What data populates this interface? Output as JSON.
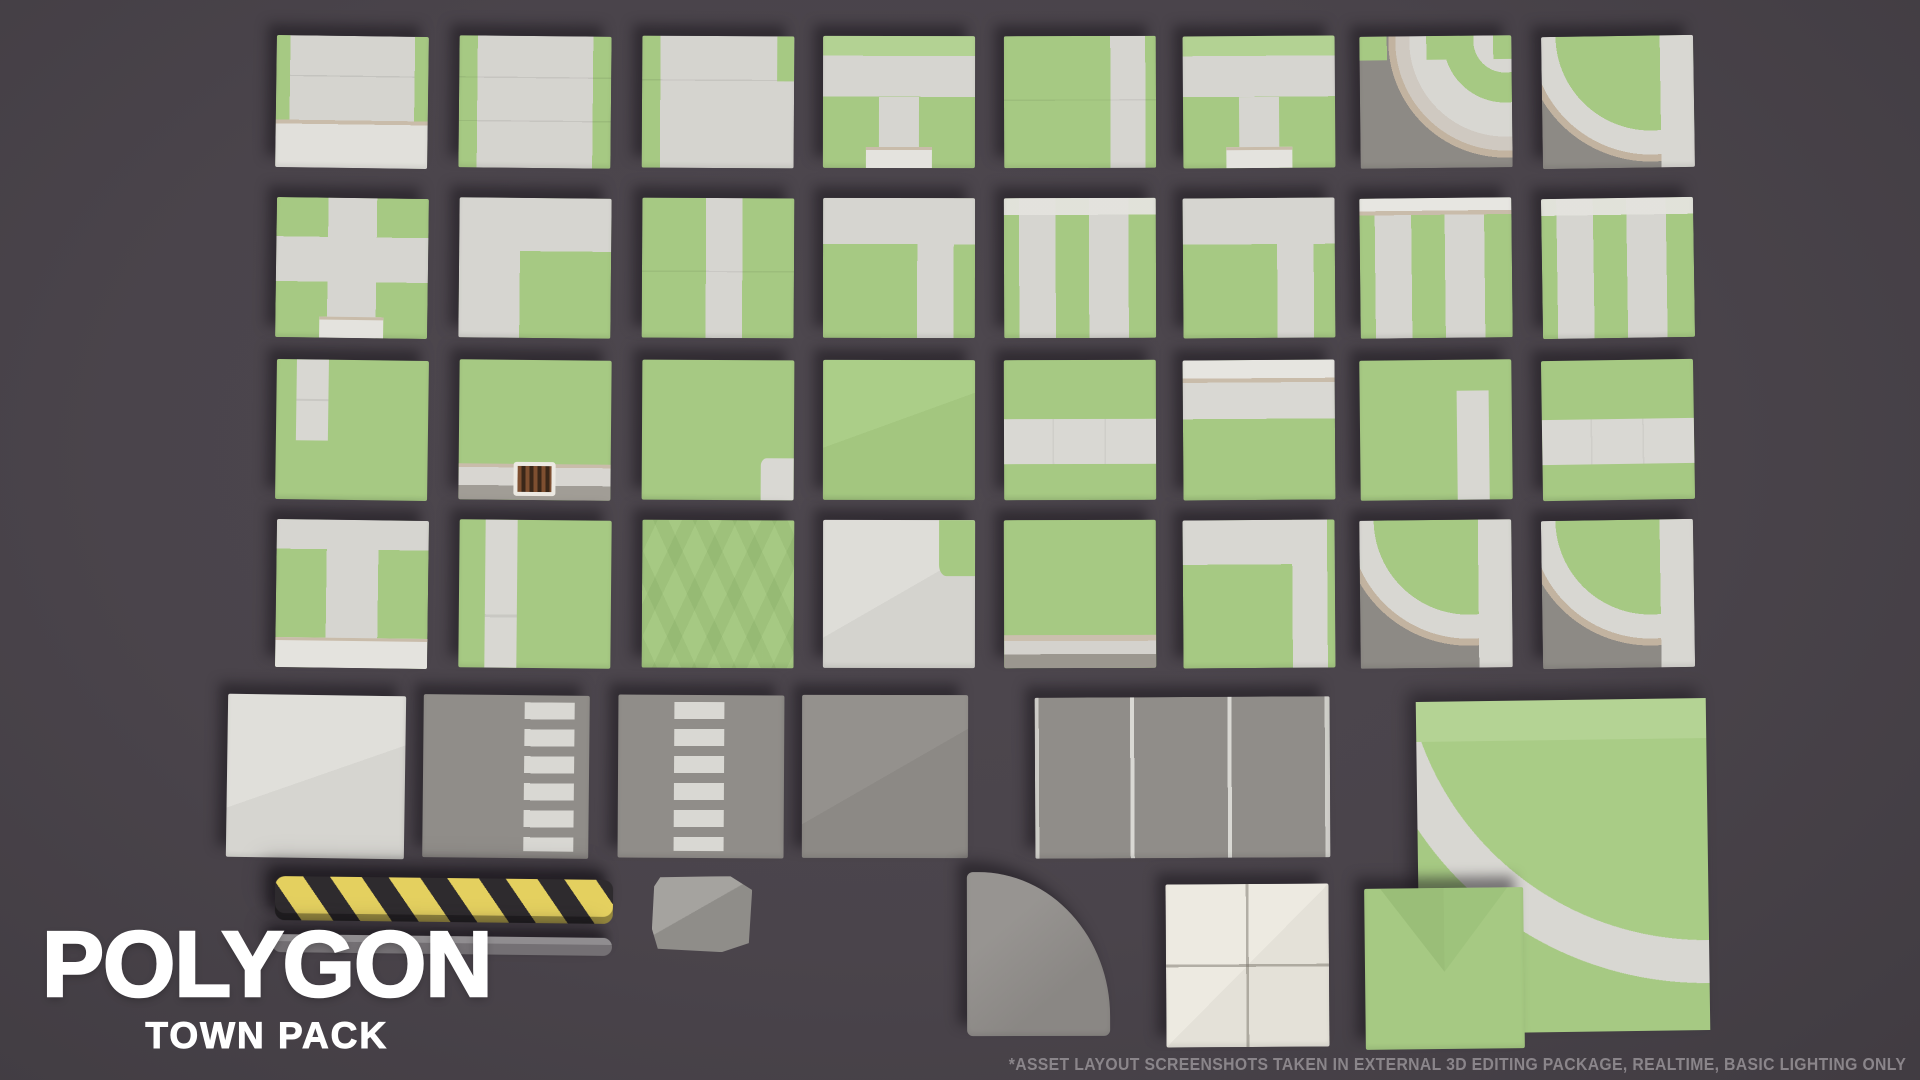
{
  "brand": {
    "title": "POLYGON",
    "subtitle": "TOWN PACK"
  },
  "footnote": "*ASSET LAYOUT SCREENSHOTS TAKEN IN EXTERNAL 3D EDITING PACKAGE, REALTIME, BASIC LIGHTING ONLY",
  "palette": {
    "background": "#4a444b",
    "grass": "#a6c983",
    "grass_light": "#b3d293",
    "grass_dark": "#90b56f",
    "sidewalk": "#d6d5d0",
    "sidewalk_bright": "#e4e3de",
    "curb_tan": "#c9bcaa",
    "asphalt": "#908d89",
    "asphalt_dark": "#8d8a85",
    "stripe_white": "#d9d8d3",
    "pavement_cream": "#edeae1",
    "bump_yellow": "#e4d05f",
    "bump_black": "#2e2b2e",
    "drain_brown": "#7e4f30",
    "logo_white": "#ffffff",
    "footnote_gray": "#8a858a"
  },
  "asset_grid": {
    "rows": [
      {
        "name": "row-1",
        "tiles": [
          {
            "name": "tile-road-end-curb",
            "pattern": "road-end",
            "x": 276,
            "y": 36,
            "w": 152,
            "h": 132
          },
          {
            "name": "tile-road-grass-sides",
            "pattern": "road-v",
            "x": 459,
            "y": 36,
            "w": 152,
            "h": 132
          },
          {
            "name": "tile-road-grass-left",
            "pattern": "road-v-left",
            "x": 642,
            "y": 36,
            "w": 152,
            "h": 132
          },
          {
            "name": "tile-sidewalk-tee",
            "pattern": "sidewalk-t",
            "x": 823,
            "y": 36,
            "w": 152,
            "h": 132
          },
          {
            "name": "tile-grass-road-right",
            "pattern": "grass-road-right",
            "x": 1004,
            "y": 36,
            "w": 152,
            "h": 132
          },
          {
            "name": "tile-sidewalk-tee-b",
            "pattern": "sidewalk-t",
            "x": 1183,
            "y": 36,
            "w": 152,
            "h": 132
          },
          {
            "name": "tile-curb-corner-cross",
            "pattern": "curve-a",
            "x": 1360,
            "y": 36,
            "w": 152,
            "h": 132
          },
          {
            "name": "tile-curb-corner-edge",
            "pattern": "curve-b",
            "x": 1542,
            "y": 36,
            "w": 152,
            "h": 132
          }
        ]
      },
      {
        "name": "row-2",
        "tiles": [
          {
            "name": "tile-sidewalk-cross",
            "pattern": "sidewalk-cross",
            "x": 276,
            "y": 198,
            "w": 152,
            "h": 140
          },
          {
            "name": "tile-sidewalk-corner",
            "pattern": "sidewalk-corner-tl",
            "x": 459,
            "y": 198,
            "w": 152,
            "h": 140
          },
          {
            "name": "tile-grass-road-center",
            "pattern": "grass-road-center",
            "x": 642,
            "y": 198,
            "w": 152,
            "h": 140
          },
          {
            "name": "tile-sidewalk-top-tee",
            "pattern": "sidewalk-top",
            "x": 823,
            "y": 198,
            "w": 152,
            "h": 140
          },
          {
            "name": "tile-grass-road-mix",
            "pattern": "grass-v-mix",
            "x": 1004,
            "y": 198,
            "w": 152,
            "h": 140
          },
          {
            "name": "tile-sidewalk-top-tee-b",
            "pattern": "sidewalk-top",
            "x": 1183,
            "y": 198,
            "w": 152,
            "h": 140
          },
          {
            "name": "tile-grass-road-mix-curb",
            "pattern": "grass-v-mix2",
            "x": 1360,
            "y": 198,
            "w": 152,
            "h": 140
          },
          {
            "name": "tile-grass-road-mix-b",
            "pattern": "grass-v-mix",
            "x": 1542,
            "y": 198,
            "w": 152,
            "h": 140
          }
        ]
      },
      {
        "name": "row-3",
        "tiles": [
          {
            "name": "tile-grass-path-left",
            "pattern": "grass-path-left",
            "x": 276,
            "y": 360,
            "w": 152,
            "h": 140
          },
          {
            "name": "tile-grass-curb-drain",
            "pattern": "grass-drain",
            "x": 459,
            "y": 360,
            "w": 152,
            "h": 140
          },
          {
            "name": "tile-grass-corner-chip",
            "pattern": "grass-chip",
            "x": 642,
            "y": 360,
            "w": 152,
            "h": 140
          },
          {
            "name": "tile-grass-plain",
            "pattern": "grass",
            "x": 823,
            "y": 360,
            "w": 152,
            "h": 140
          },
          {
            "name": "tile-grass-road-horizontal",
            "pattern": "grass-road-h",
            "x": 1004,
            "y": 360,
            "w": 152,
            "h": 140
          },
          {
            "name": "tile-grass-curb-top",
            "pattern": "grass-curb-top",
            "x": 1183,
            "y": 360,
            "w": 152,
            "h": 140
          },
          {
            "name": "tile-grass-path-right",
            "pattern": "grass-path-right",
            "x": 1360,
            "y": 360,
            "w": 152,
            "h": 140
          },
          {
            "name": "tile-grass-road-horizontal-b",
            "pattern": "grass-road-h",
            "x": 1542,
            "y": 360,
            "w": 152,
            "h": 140
          }
        ]
      },
      {
        "name": "row-4",
        "tiles": [
          {
            "name": "tile-sidewalk-tee-curb",
            "pattern": "sidewalk-t-curb",
            "x": 276,
            "y": 520,
            "w": 152,
            "h": 148
          },
          {
            "name": "tile-grass-path-left-b",
            "pattern": "grass-path-left2",
            "x": 459,
            "y": 520,
            "w": 152,
            "h": 148
          },
          {
            "name": "tile-grass-chevrons",
            "pattern": "grass-chevrons",
            "x": 642,
            "y": 520,
            "w": 152,
            "h": 148
          },
          {
            "name": "tile-pavement-grass-corner",
            "pattern": "pavement-corner",
            "x": 823,
            "y": 520,
            "w": 152,
            "h": 148
          },
          {
            "name": "tile-grass-curb-bottom",
            "pattern": "grass-curb-bottom",
            "x": 1004,
            "y": 520,
            "w": 152,
            "h": 148
          },
          {
            "name": "tile-sidewalk-corner-band",
            "pattern": "sidewalk-corner-band",
            "x": 1183,
            "y": 520,
            "w": 152,
            "h": 148
          },
          {
            "name": "tile-curb-curve-c",
            "pattern": "curve-b",
            "x": 1360,
            "y": 520,
            "w": 152,
            "h": 148
          },
          {
            "name": "tile-curb-curve-d",
            "pattern": "curve-b",
            "x": 1542,
            "y": 520,
            "w": 152,
            "h": 148
          }
        ]
      },
      {
        "name": "row-5",
        "tiles": [
          {
            "name": "tile-pavement-plain",
            "pattern": "pavement",
            "x": 227,
            "y": 695,
            "w": 178,
            "h": 163
          },
          {
            "name": "tile-crosswalk-right",
            "pattern": "crosswalk-a",
            "x": 423,
            "y": 695,
            "w": 166,
            "h": 163
          },
          {
            "name": "tile-crosswalk-center",
            "pattern": "crosswalk-b",
            "x": 618,
            "y": 695,
            "w": 166,
            "h": 163
          },
          {
            "name": "tile-asphalt-plain",
            "pattern": "asphalt",
            "x": 802,
            "y": 695,
            "w": 166,
            "h": 163
          },
          {
            "name": "tile-asphalt-two-lane",
            "pattern": "asphalt-lanes",
            "x": 1035,
            "y": 697,
            "w": 295,
            "h": 161
          },
          {
            "name": "tile-curved-road-corner",
            "pattern": "big-curve",
            "x": 1418,
            "y": 700,
            "w": 290,
            "h": 332,
            "special": "noclip"
          }
        ]
      },
      {
        "name": "row-6",
        "tiles": [
          {
            "name": "speed-bump",
            "pattern": "speed-bump",
            "x": 275,
            "y": 878,
            "w": 338,
            "h": 44,
            "special": "noclip"
          },
          {
            "name": "curb-rail",
            "pattern": "curb-bar",
            "x": 272,
            "y": 936,
            "w": 340,
            "h": 18,
            "special": "noclip"
          },
          {
            "name": "rock-block",
            "pattern": "rock",
            "x": 652,
            "y": 876,
            "w": 100,
            "h": 76,
            "special": "noclip"
          },
          {
            "name": "tile-asphalt-rounded-corner",
            "pattern": "quarter-round",
            "x": 967,
            "y": 872,
            "w": 143,
            "h": 164
          },
          {
            "name": "tile-pavement-quad",
            "pattern": "white-quad",
            "x": 1166,
            "y": 884,
            "w": 163,
            "h": 163
          },
          {
            "name": "tile-grass-facet",
            "pattern": "green-v",
            "x": 1365,
            "y": 888,
            "w": 159,
            "h": 161
          }
        ]
      }
    ]
  }
}
